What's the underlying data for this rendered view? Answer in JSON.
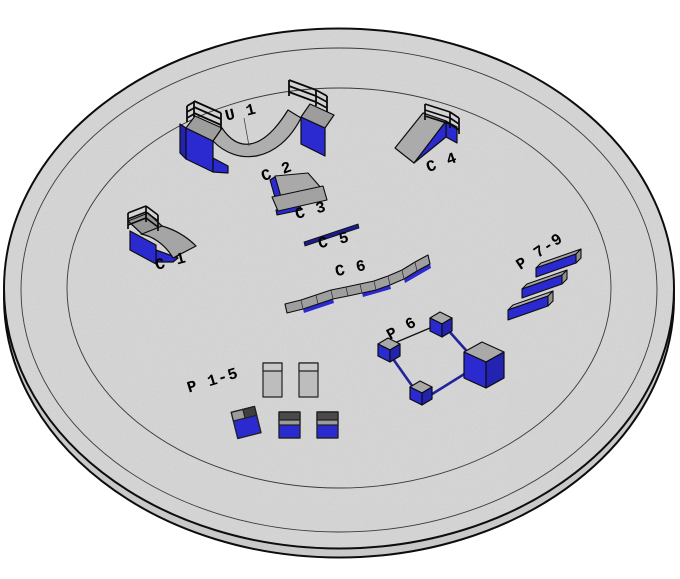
{
  "scene": {
    "colors": {
      "obstacle_blue": "#2a2ad0",
      "obstacle_blue_dark": "#2323b2",
      "surface_gray": "#a9a9a9",
      "ground_gray": "#d8d8d8",
      "rail_navy": "#1c1c86",
      "outline_black": "#0d0d0d"
    },
    "obstacles": {
      "u1": {
        "label": "U 1",
        "kind": "halfpipe"
      },
      "c1": {
        "label": "C 1",
        "kind": "quarterpipe"
      },
      "c2": {
        "label": "C 2",
        "kind": "bank-ramp"
      },
      "c3": {
        "label": "C 3",
        "kind": "bank-ramp"
      },
      "c4": {
        "label": "C 4",
        "kind": "bank-ramp-with-rail"
      },
      "c5": {
        "label": "C 5",
        "kind": "flat-rail"
      },
      "c6": {
        "label": "C 6",
        "kind": "wave-ledge"
      },
      "p1_5": {
        "label": "P 1-5",
        "kind": "pads-and-boxes-group"
      },
      "p6": {
        "label": "P 6",
        "kind": "post-rail-square"
      },
      "p7_9": {
        "label": "P 7-9",
        "kind": "ledge-set"
      }
    }
  }
}
